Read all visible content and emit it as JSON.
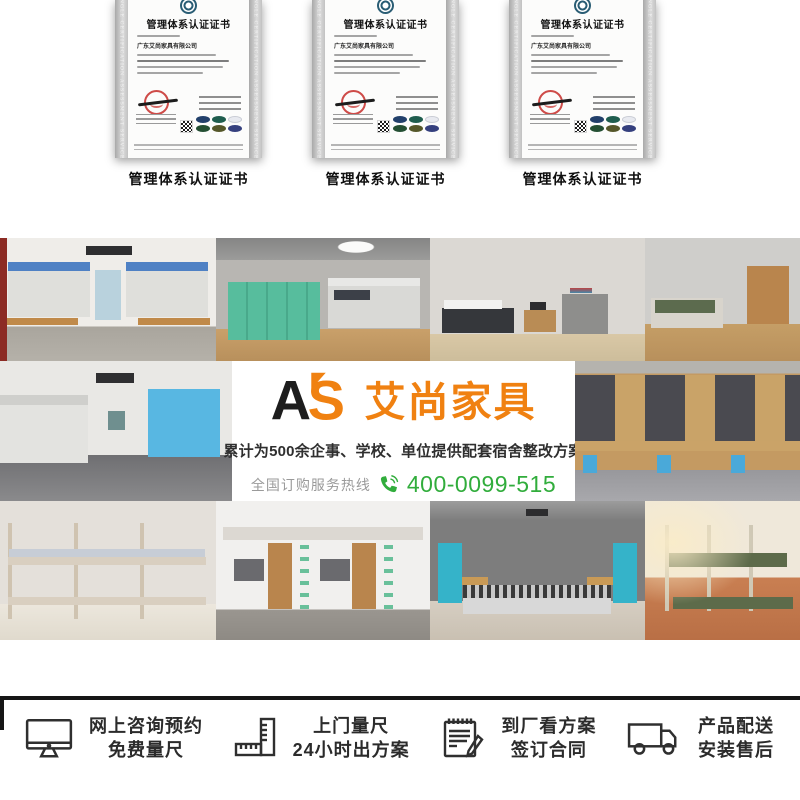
{
  "certificates": {
    "caption": "管理体系认证证书",
    "title": "管理体系认证证书",
    "company": "广东艾尚家具有限公司",
    "side_text": "ANGLE CERTIFICATION ASSESSMENT SERVICES"
  },
  "banner": {
    "logo": {
      "letter_a": "A",
      "letter_s": "S",
      "brand": "艾尚家具"
    },
    "tagline": "累计为500余企事、学校、单位提供配套宿舍整改方案",
    "hotline_label": "全国订购服务热线",
    "hotline_number": "400-0099-515",
    "colors": {
      "brand_orange": "#f08111",
      "hotline_green": "#31ad3c",
      "tagline_dark": "#2f2f2f"
    }
  },
  "services": {
    "items": [
      {
        "icon": "monitor-icon",
        "line1": "网上咨询预约",
        "line2": "免费量尺"
      },
      {
        "icon": "ruler-icon",
        "line1": "上门量尺",
        "line2": "24小时出方案"
      },
      {
        "icon": "contract-icon",
        "line1": "到厂看方案",
        "line2": "签订合同"
      },
      {
        "icon": "truck-icon",
        "line1": "产品配送",
        "line2": "安装售后"
      }
    ]
  }
}
